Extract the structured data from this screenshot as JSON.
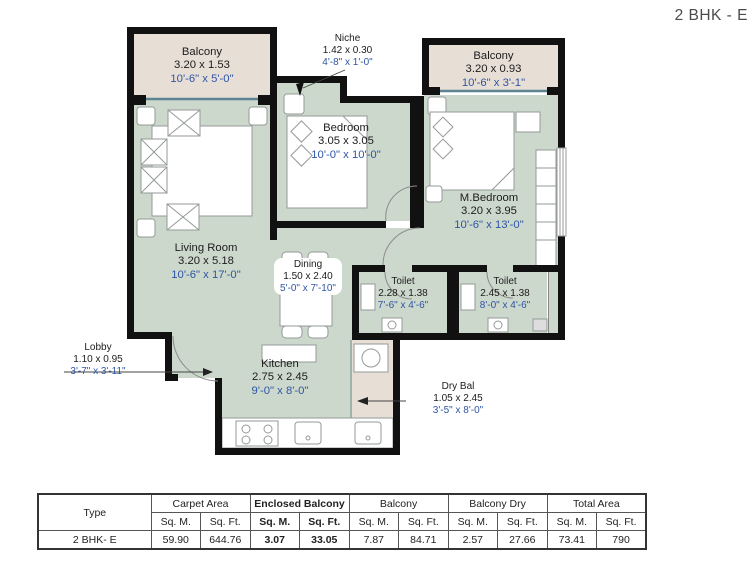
{
  "title": "2 BHK - E",
  "colors": {
    "room_fill": "#cdd8cc",
    "balcony_fill": "#e7ded6",
    "wall": "#111111",
    "dimension_blue": "#2e55a5"
  },
  "rooms": {
    "balcony_left": {
      "name": "Balcony",
      "metric": "3.20 x 1.53",
      "imperial": "10'-6\" x 5'-0\""
    },
    "niche": {
      "name": "Niche",
      "metric": "1.42 x 0.30",
      "imperial": "4'-8\" x 1'-0\""
    },
    "balcony_right": {
      "name": "Balcony",
      "metric": "3.20 x 0.93",
      "imperial": "10'-6\" x 3'-1\""
    },
    "bedroom": {
      "name": "Bedroom",
      "metric": "3.05 x 3.05",
      "imperial": "10'-0\" x 10'-0\""
    },
    "m_bedroom": {
      "name": "M.Bedroom",
      "metric": "3.20 x 3.95",
      "imperial": "10'-6\" x 13'-0\""
    },
    "living_room": {
      "name": "Living Room",
      "metric": "3.20 x 5.18",
      "imperial": "10'-6\" x 17'-0\""
    },
    "dining": {
      "name": "Dining",
      "metric": "1.50 x 2.40",
      "imperial": "5'-0\" x 7'-10\""
    },
    "toilet_1": {
      "name": "Toilet",
      "metric": "2.28 x 1.38",
      "imperial": "7'-6\" x 4'-6\""
    },
    "toilet_2": {
      "name": "Toilet",
      "metric": "2.45 x 1.38",
      "imperial": "8'-0\" x 4'-6\""
    },
    "lobby": {
      "name": "Lobby",
      "metric": "1.10 x 0.95",
      "imperial": "3'-7\" x 3'-11\""
    },
    "kitchen": {
      "name": "Kitchen",
      "metric": "2.75 x 2.45",
      "imperial": "9'-0\" x 8'-0\""
    },
    "dry_bal": {
      "name": "Dry Bal",
      "metric": "1.05 x 2.45",
      "imperial": "3'-5\" x 8'-0\""
    }
  },
  "table": {
    "type_header": "Type",
    "unit_m": "Sq. M.",
    "unit_ft": "Sq. Ft.",
    "row_type": "2 BHK- E",
    "groups": [
      {
        "label": "Carpet Area",
        "m": "59.90",
        "ft": "644.76"
      },
      {
        "label": "Enclosed Balcony",
        "m": "3.07",
        "ft": "33.05"
      },
      {
        "label": "Balcony",
        "m": "7.87",
        "ft": "84.71"
      },
      {
        "label": "Balcony Dry",
        "m": "2.57",
        "ft": "27.66"
      },
      {
        "label": "Total Area",
        "m": "73.41",
        "ft": "790"
      }
    ]
  }
}
